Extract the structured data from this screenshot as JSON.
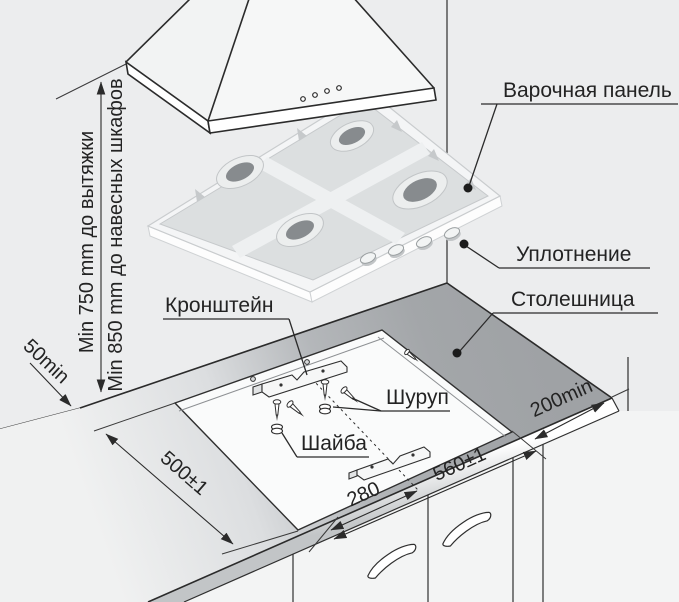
{
  "diagram": {
    "labels": {
      "hob_panel": "Варочная панель",
      "seal": "Уплотнение",
      "countertop": "Столешница",
      "bracket": "Кронштейн",
      "screw": "Шуруп",
      "washer": "Шайба"
    },
    "dimensions": {
      "hood_clearance": "Min 750 mm до вытяжки",
      "upper_cabinet_clearance": "Min 850 mm до навесных шкафов",
      "rear_gap": "50min",
      "cutout_depth": "500±1",
      "bracket_center_offset": "280",
      "cutout_width": "560±1",
      "right_gap": "200min"
    },
    "colors": {
      "background": "#ecedee",
      "countertop_gray": "#a2a5a8",
      "cutout_white": "#fafbfb",
      "line": "#2b2b2b"
    }
  }
}
